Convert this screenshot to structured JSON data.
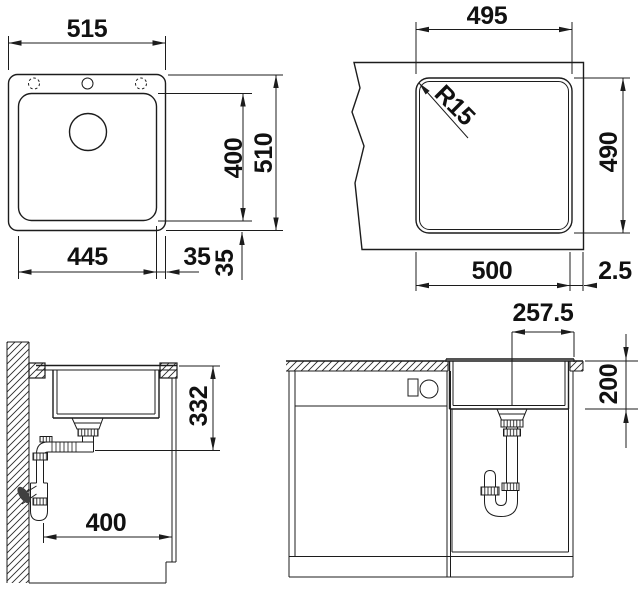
{
  "drawing": {
    "background": "#ffffff",
    "line_color": "#1c1c1c",
    "text_color": "#111111",
    "views": {
      "top": {
        "label": "sink top view",
        "dims": {
          "overall_width": "515",
          "overall_depth": "510",
          "bowl_depth": "400",
          "bowl_width": "445",
          "right_margin": "35",
          "bottom_margin": "35"
        }
      },
      "cutout": {
        "label": "worktop cutout plan",
        "dims": {
          "cutout_width": "495",
          "corner_radius": "R15",
          "cutout_depth": "490",
          "recess_width": "500",
          "edge_offset": "2.5"
        }
      },
      "side_section": {
        "label": "side section with drain trap",
        "dims": {
          "outlet_height": "332",
          "cabinet_depth": "400"
        }
      },
      "front_section": {
        "label": "front section in cabinet",
        "dims": {
          "drain_center_offset": "257.5",
          "bowl_inner_depth": "200"
        }
      }
    }
  }
}
